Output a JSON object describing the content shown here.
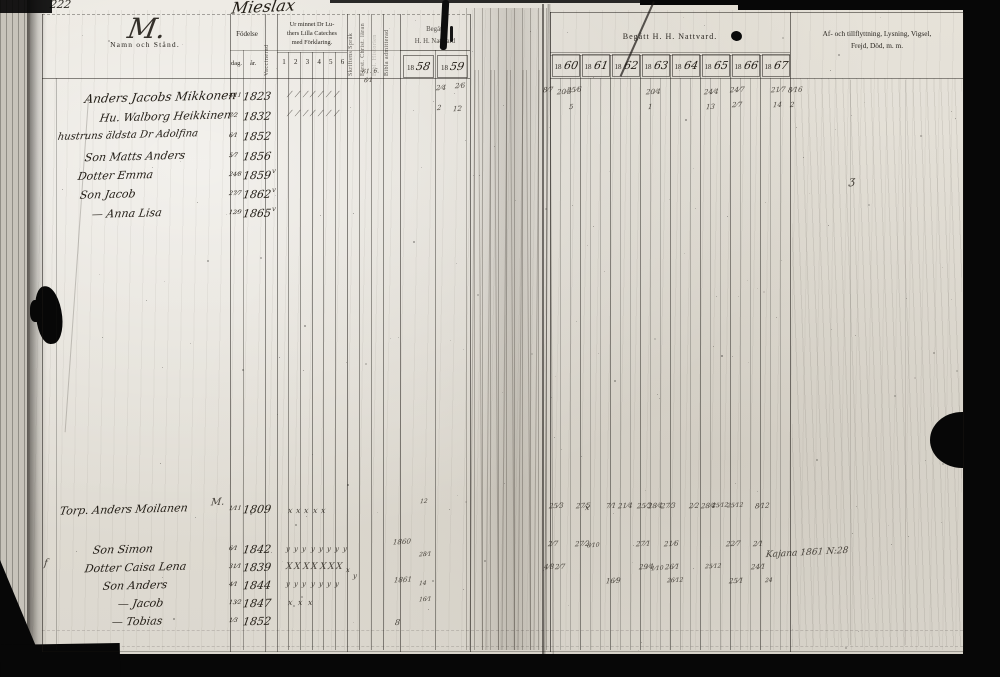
{
  "page": {
    "page_number": "222",
    "village_title": "Mieslax"
  },
  "left_page": {
    "header": {
      "ornament_letter": "M.",
      "name_col": "Namn och Stånd.",
      "birth_col": "Födelse",
      "birth_sub": [
        "dag.",
        "år."
      ],
      "vaccinated_col": "Vaccinerad",
      "catechism_col": "Ur minnet Dr Lu-\nthers Lilla Cateches\nmed Förklaring.",
      "catechism_sub": [
        "1",
        "2",
        "3",
        "4",
        "5",
        "6"
      ],
      "rotated_cols": [
        "Skriftens Språk",
        "Först. Christ. läran",
        "Bibl. Historien",
        "Bibla admitterad"
      ],
      "communion_col": "Begått\nH. H. Nattvard",
      "communion_years": [
        {
          "printed": "18",
          "written": "58"
        },
        {
          "printed": "18",
          "written": "59"
        }
      ]
    },
    "rows": [
      {
        "name": "Anders Jacobs Mikkonen",
        "birth_day": "4⁄11",
        "birth_year": "1823"
      },
      {
        "name": "Hu. Walborg Heikkinen",
        "birth_day": "7⁄2",
        "birth_year": "1832"
      },
      {
        "name": "hustruns äldsta Dr Adolfina",
        "birth_day": "6⁄1",
        "birth_year": "1852"
      },
      {
        "name": "Son Matts Anders",
        "birth_day": "5⁄7",
        "birth_year": "1856"
      },
      {
        "name": "Dotter Emma",
        "birth_day": "24⁄8",
        "birth_year": "1859"
      },
      {
        "name": "Son Jacob",
        "birth_day": "27⁄7",
        "birth_year": "1862"
      },
      {
        "name": "— Anna Lisa",
        "birth_day": "12⁄9",
        "birth_year": "1865"
      },
      {
        "name": "Torp. Anders Moilanen",
        "birth_day": "1⁄11",
        "birth_year": "1809"
      },
      {
        "name": "Son Simon",
        "birth_day": "6⁄1",
        "birth_year": "1842"
      },
      {
        "name": "Dotter Caisa Lena",
        "birth_day": "31⁄1",
        "birth_year": "1839"
      },
      {
        "name": "Son Anders",
        "birth_day": "4⁄1",
        "birth_year": "1844"
      },
      {
        "name": "— Jacob",
        "birth_day": "13⁄2",
        "birth_year": "1847"
      },
      {
        "name": "— Tobias",
        "birth_day": "1⁄3",
        "birth_year": "1852"
      }
    ]
  },
  "right_page": {
    "header": {
      "communion_col": "Begått  H.  H.  Nattvard.",
      "years": [
        {
          "printed": "18",
          "written": "60"
        },
        {
          "printed": "18",
          "written": "61"
        },
        {
          "printed": "18",
          "written": "62"
        },
        {
          "printed": "18",
          "written": "63"
        },
        {
          "printed": "18",
          "written": "64"
        },
        {
          "printed": "18",
          "written": "65"
        },
        {
          "printed": "18",
          "written": "66"
        },
        {
          "printed": "18",
          "written": "67"
        }
      ],
      "notes_col": "Af- och tillflyttning, Lysning, Vigsel,\nFrejd, Död, m. m."
    },
    "note": "Kajana 1861 N:28"
  },
  "annotations": {
    "groups": [
      {
        "y": 90,
        "x0": 289,
        "dx": 7.8,
        "n": 7,
        "t": "⁄",
        "s": 8
      },
      {
        "y": 109,
        "x0": 289,
        "dx": 7.8,
        "n": 7,
        "t": "⁄",
        "s": 8
      },
      {
        "y": 506,
        "x0": 288,
        "dx": 8.2,
        "n": 5,
        "t": "x",
        "s": 8
      },
      {
        "y": 545,
        "x0": 286,
        "dx": 8.2,
        "n": 8,
        "t": "y",
        "s": 7
      },
      {
        "y": 562,
        "x0": 286,
        "dx": 8.4,
        "n": 7,
        "t": "X",
        "s": 9
      },
      {
        "y": 580,
        "x0": 286,
        "dx": 8.2,
        "n": 7,
        "t": "y",
        "s": 7
      },
      {
        "y": 598,
        "x0": 288,
        "dx": 10,
        "n": 3,
        "t": "x",
        "s": 8
      }
    ],
    "singles": [
      {
        "x": 272,
        "y": 167,
        "t": "v",
        "s": 7
      },
      {
        "x": 272,
        "y": 186,
        "t": "v",
        "s": 7
      },
      {
        "x": 272,
        "y": 205,
        "t": "v",
        "s": 7
      },
      {
        "x": 362,
        "y": 68,
        "t": "61. 6.",
        "s": 6
      },
      {
        "x": 364,
        "y": 77,
        "t": "6⁄1",
        "s": 6
      },
      {
        "x": 436,
        "y": 84,
        "t": "2⁄4",
        "s": 7
      },
      {
        "x": 455,
        "y": 82,
        "t": "2⁄6",
        "s": 7
      },
      {
        "x": 437,
        "y": 104,
        "t": "2",
        "s": 7
      },
      {
        "x": 453,
        "y": 105,
        "t": "12",
        "s": 7
      },
      {
        "x": 211,
        "y": 497,
        "t": "M.",
        "s": 10
      },
      {
        "x": 420,
        "y": 498,
        "t": "12",
        "s": 6
      },
      {
        "x": 393,
        "y": 538,
        "t": "1860",
        "s": 7
      },
      {
        "x": 419,
        "y": 551,
        "t": "28⁄1",
        "s": 6
      },
      {
        "x": 346,
        "y": 566,
        "t": "x",
        "s": 7
      },
      {
        "x": 353,
        "y": 572,
        "t": "y",
        "s": 7
      },
      {
        "x": 394,
        "y": 576,
        "t": "1861",
        "s": 7
      },
      {
        "x": 419,
        "y": 580,
        "t": "14",
        "s": 6
      },
      {
        "x": 419,
        "y": 596,
        "t": "16⁄1",
        "s": 6
      },
      {
        "x": 44,
        "y": 558,
        "t": "f",
        "s": 10
      },
      {
        "x": 395,
        "y": 618,
        "t": "8",
        "s": 8
      },
      {
        "x": 849,
        "y": 174,
        "t": "ʒ",
        "s": 11
      },
      {
        "x": 543,
        "y": 86,
        "t": "8⁄7",
        "s": 7
      },
      {
        "x": 557,
        "y": 88,
        "t": "20⁄3",
        "s": 7
      },
      {
        "x": 567,
        "y": 86,
        "t": "25⁄6",
        "s": 7
      },
      {
        "x": 569,
        "y": 103,
        "t": "5",
        "s": 7
      },
      {
        "x": 646,
        "y": 88,
        "t": "20⁄4",
        "s": 7
      },
      {
        "x": 648,
        "y": 103,
        "t": "1",
        "s": 7
      },
      {
        "x": 704,
        "y": 88,
        "t": "24⁄4",
        "s": 7
      },
      {
        "x": 706,
        "y": 103,
        "t": "13",
        "s": 7
      },
      {
        "x": 730,
        "y": 86,
        "t": "24⁄7",
        "s": 7
      },
      {
        "x": 732,
        "y": 101,
        "t": "2⁄7",
        "s": 7
      },
      {
        "x": 771,
        "y": 86,
        "t": "21⁄7",
        "s": 7
      },
      {
        "x": 773,
        "y": 101,
        "t": "14",
        "s": 7
      },
      {
        "x": 788,
        "y": 86,
        "t": "8⁄16",
        "s": 7
      },
      {
        "x": 790,
        "y": 101,
        "t": "2",
        "s": 7
      },
      {
        "x": 549,
        "y": 502,
        "t": "25⁄3",
        "s": 7
      },
      {
        "x": 576,
        "y": 502,
        "t": "27⁄5",
        "s": 7
      },
      {
        "x": 585,
        "y": 503,
        "t": "x",
        "s": 8
      },
      {
        "x": 606,
        "y": 502,
        "t": "7⁄1",
        "s": 7
      },
      {
        "x": 618,
        "y": 502,
        "t": "21⁄4",
        "s": 7
      },
      {
        "x": 637,
        "y": 502,
        "t": "25⁄3",
        "s": 7
      },
      {
        "x": 648,
        "y": 502,
        "t": "28⁄4",
        "s": 7
      },
      {
        "x": 661,
        "y": 502,
        "t": "27⁄3",
        "s": 7
      },
      {
        "x": 689,
        "y": 502,
        "t": "2⁄2",
        "s": 7
      },
      {
        "x": 701,
        "y": 502,
        "t": "28⁄4",
        "s": 7
      },
      {
        "x": 712,
        "y": 502,
        "t": "25⁄12",
        "s": 6
      },
      {
        "x": 727,
        "y": 502,
        "t": "25⁄12",
        "s": 6
      },
      {
        "x": 755,
        "y": 502,
        "t": "8⁄12",
        "s": 7
      },
      {
        "x": 548,
        "y": 540,
        "t": "2⁄7",
        "s": 7
      },
      {
        "x": 575,
        "y": 540,
        "t": "27⁄2",
        "s": 7
      },
      {
        "x": 587,
        "y": 542,
        "t": "8⁄10",
        "s": 6
      },
      {
        "x": 636,
        "y": 540,
        "t": "27⁄1",
        "s": 7
      },
      {
        "x": 664,
        "y": 540,
        "t": "21⁄6",
        "s": 7
      },
      {
        "x": 726,
        "y": 540,
        "t": "22⁄7",
        "s": 7
      },
      {
        "x": 753,
        "y": 540,
        "t": "2⁄1",
        "s": 7
      },
      {
        "x": 544,
        "y": 563,
        "t": "4⁄8",
        "s": 7
      },
      {
        "x": 555,
        "y": 563,
        "t": "2⁄7",
        "s": 7
      },
      {
        "x": 639,
        "y": 563,
        "t": "29⁄4",
        "s": 7
      },
      {
        "x": 651,
        "y": 565,
        "t": "1⁄10",
        "s": 6
      },
      {
        "x": 665,
        "y": 563,
        "t": "26⁄1",
        "s": 7
      },
      {
        "x": 705,
        "y": 563,
        "t": "25⁄12",
        "s": 6
      },
      {
        "x": 751,
        "y": 563,
        "t": "24⁄1",
        "s": 7
      },
      {
        "x": 606,
        "y": 577,
        "t": "16⁄9",
        "s": 7
      },
      {
        "x": 667,
        "y": 577,
        "t": "26⁄12",
        "s": 6
      },
      {
        "x": 729,
        "y": 577,
        "t": "25⁄1",
        "s": 7
      },
      {
        "x": 765,
        "y": 577,
        "t": "24",
        "s": 6
      }
    ]
  }
}
